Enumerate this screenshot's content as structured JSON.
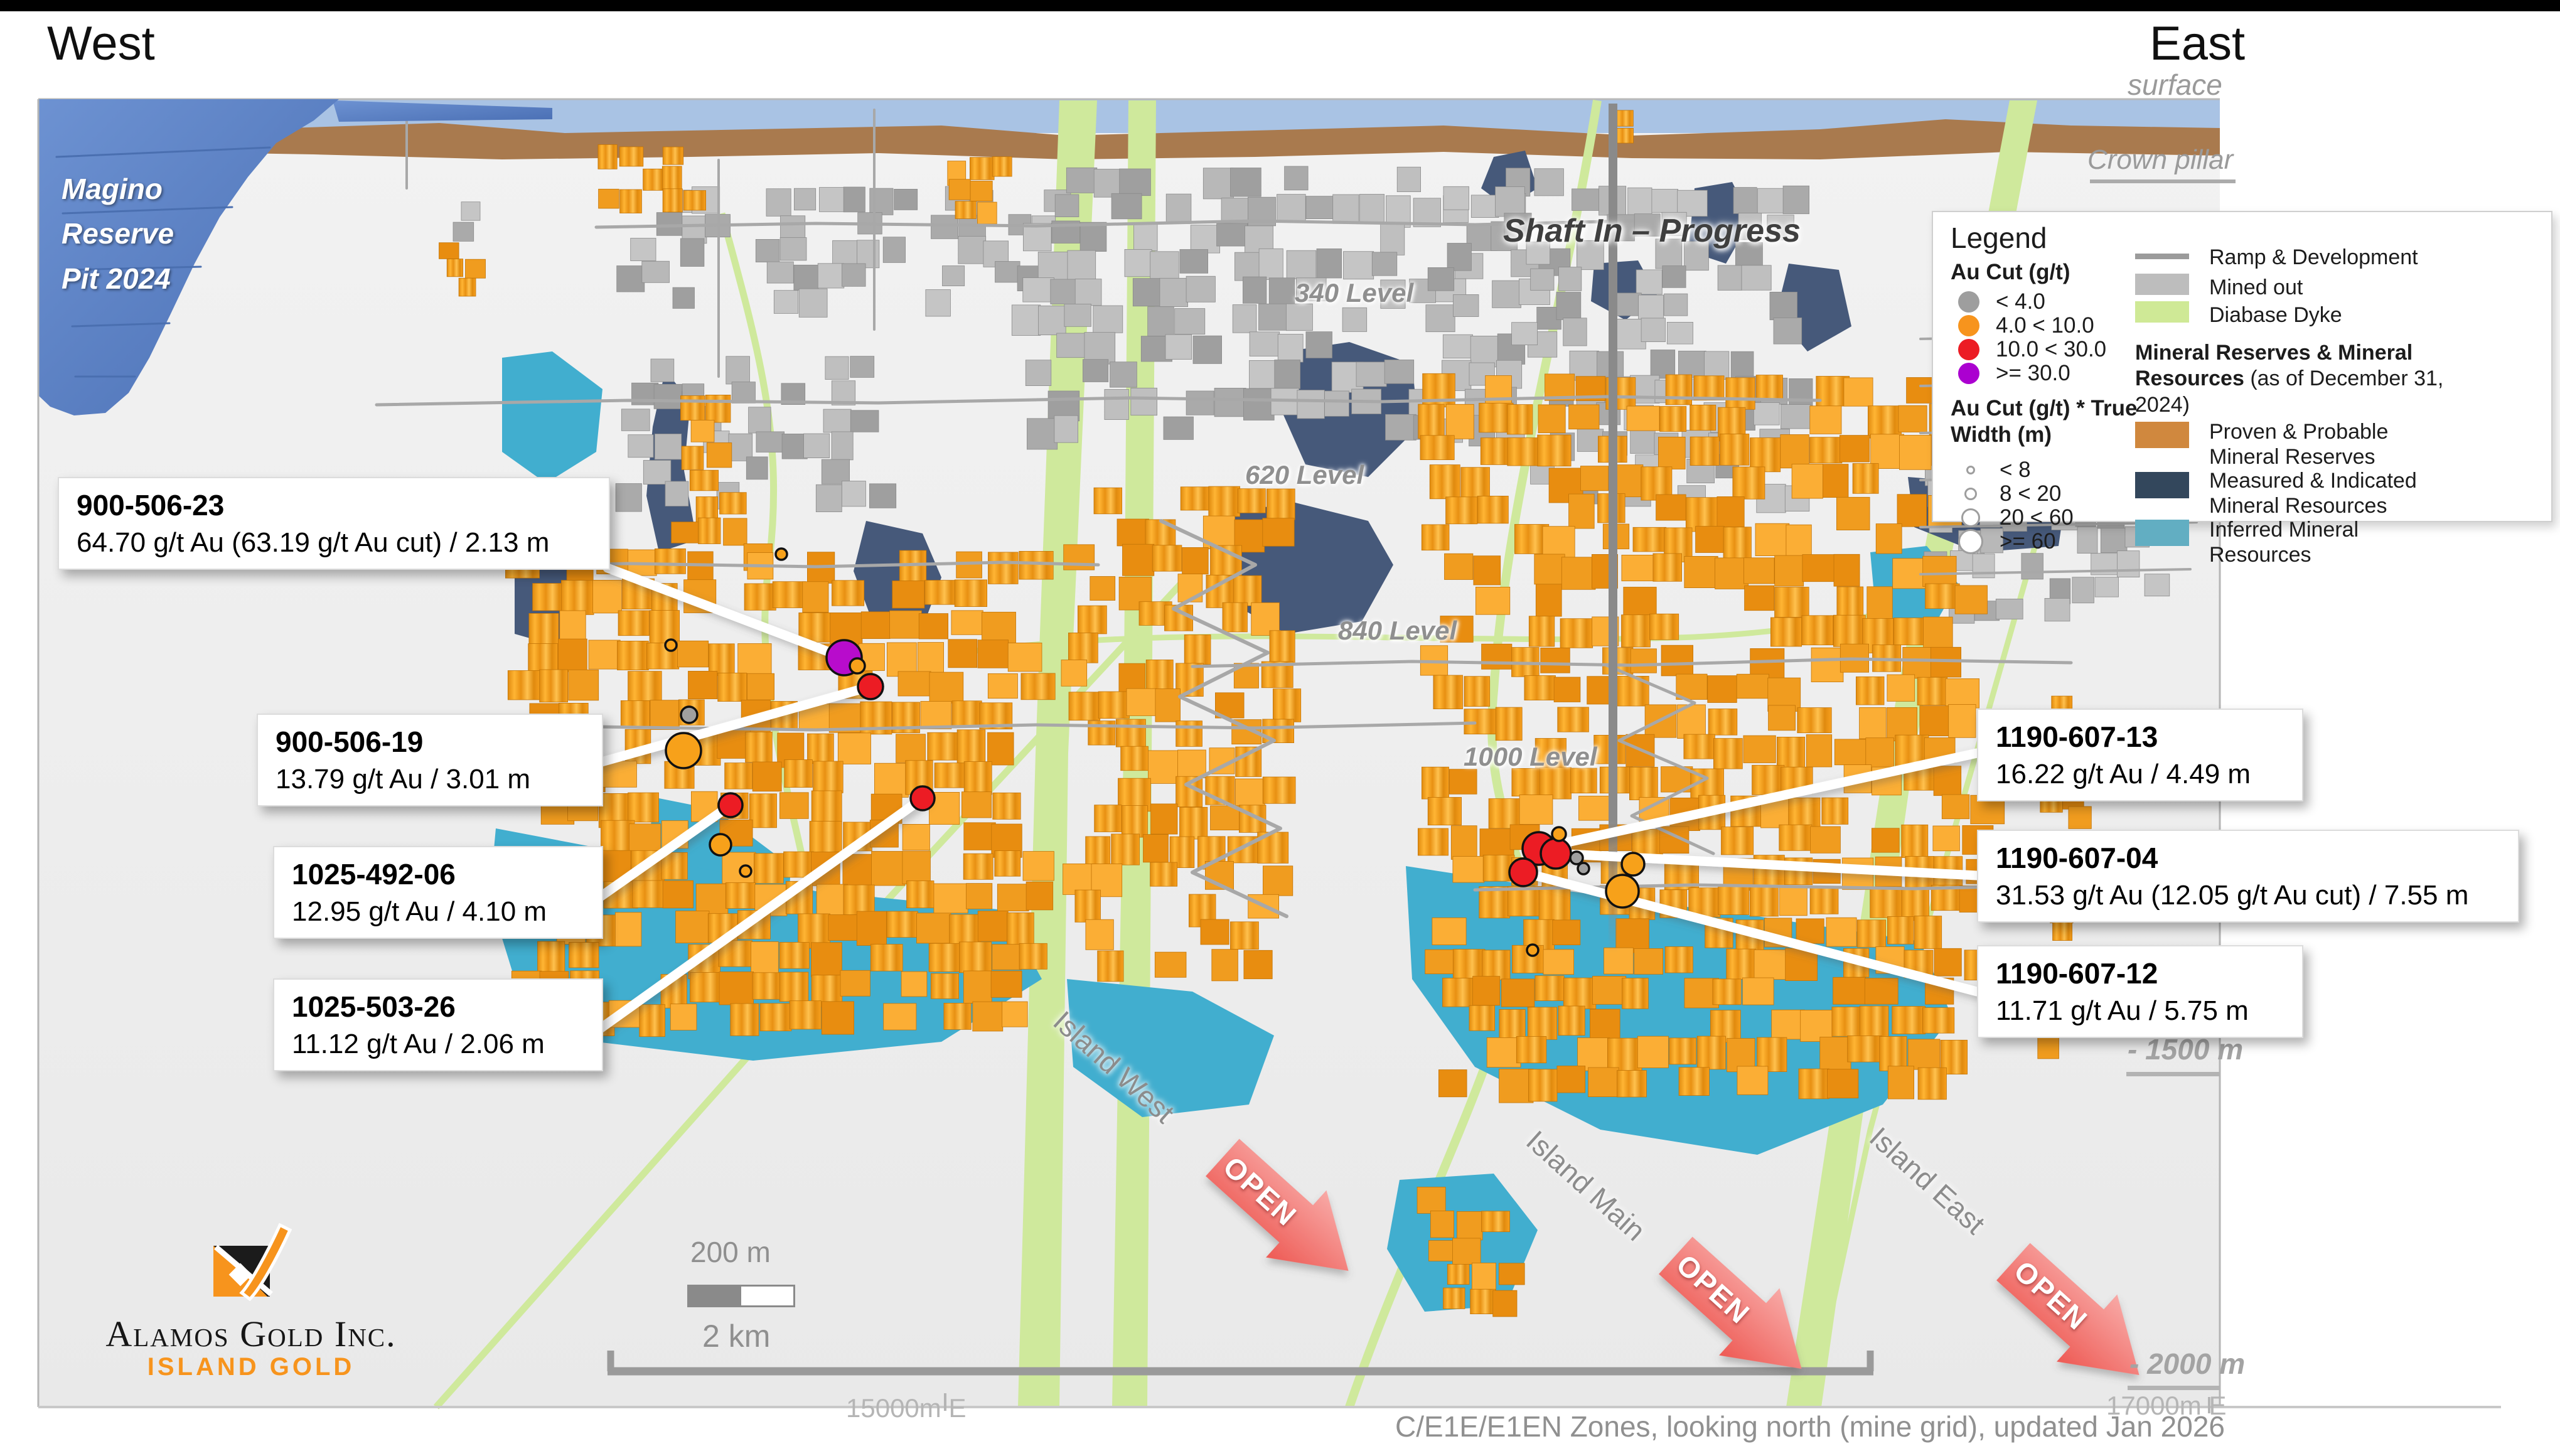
{
  "page": {
    "west": "West",
    "east": "East",
    "surface": "surface",
    "crown_pillar": "Crown pillar",
    "caption": "C/E1E/E1EN Zones, looking north (mine grid), updated Jan 2026"
  },
  "pit": {
    "line1": "Magino",
    "line2": "Reserve",
    "line3": "Pit 2024"
  },
  "shaft_label": "Shaft In – Progress",
  "levels": [
    {
      "label": "340 Level"
    },
    {
      "label": "620 Level"
    },
    {
      "label": "840 Level"
    },
    {
      "label": "1000 Level"
    }
  ],
  "callouts": [
    {
      "hole_id": "900-506-23",
      "result": "64.70 g/t Au (63.19 g/t Au cut) / 2.13 m"
    },
    {
      "hole_id": "900-506-19",
      "result": "13.79 g/t Au / 3.01 m"
    },
    {
      "hole_id": "1025-492-06",
      "result": "12.95 g/t Au / 4.10 m"
    },
    {
      "hole_id": "1025-503-26",
      "result": "11.12 g/t Au / 2.06 m"
    },
    {
      "hole_id": "1190-607-13",
      "result": "16.22 g/t Au / 4.49 m"
    },
    {
      "hole_id": "1190-607-04",
      "result": "31.53 g/t Au (12.05 g/t Au cut) / 7.55 m"
    },
    {
      "hole_id": "1190-607-12",
      "result": "11.71 g/t Au / 5.75 m"
    }
  ],
  "legend": {
    "title": "Legend",
    "au_heading": "Au Cut (g/t)",
    "au_classes": [
      {
        "label": "< 4.0",
        "color": "#9e9e9e"
      },
      {
        "label": "4.0 < 10.0",
        "color": "#f7941d"
      },
      {
        "label": "10.0 < 30.0",
        "color": "#ec1c24"
      },
      {
        "label": ">= 30.0",
        "color": "#ab00d0"
      }
    ],
    "width_heading": "Au Cut (g/t) * True Width (m)",
    "width_classes": [
      {
        "label": "< 8"
      },
      {
        "label": "8 < 20"
      },
      {
        "label": "20 < 60"
      },
      {
        "label": ">= 60"
      }
    ],
    "line_items": [
      {
        "label": "Ramp & Development",
        "color": "#9b9b9b"
      },
      {
        "label": "Mined out",
        "color": "#bdbdbd"
      },
      {
        "label": "Diabase Dyke",
        "color": "#cfe996"
      }
    ],
    "resources_heading_bold": "Mineral Reserves & Mineral Resources",
    "resources_heading_rest": " (as of December 31, 2024)",
    "resource_classes": [
      {
        "label": "Proven & Probable Mineral Reserves",
        "color": "#d0883e"
      },
      {
        "label": "Measured & Indicated Mineral Resources",
        "color": "#33475c"
      },
      {
        "label": "Inferred Mineral Resources",
        "color": "#62aec2"
      }
    ]
  },
  "zones": [
    {
      "label": "Island West"
    },
    {
      "label": "Island Main"
    },
    {
      "label": "Island East"
    }
  ],
  "open_label": "OPEN",
  "depth_markers": [
    {
      "label": "- 1500 m"
    },
    {
      "label": "- 2000 m"
    }
  ],
  "scale_bars": {
    "small": "200 m",
    "large": "2 km"
  },
  "easting_labels": [
    {
      "label": "15000m E"
    },
    {
      "label": "17000m E"
    }
  ],
  "logo": {
    "company": "Alamos Gold Inc.",
    "division": "ISLAND GOLD"
  },
  "map_colors": {
    "mined_out": "#b5b5b5",
    "stopes_proven_probable": "#f09c1f",
    "measured_indicated": "#46597a",
    "inferred": "#41aecf",
    "diabase_dyke": "#cfe99c",
    "pit": "#5b82c6",
    "overburden": "#a97a4e",
    "sky_band": "#a9c3e4",
    "open_arrow": "#ee5a54",
    "drill_dot_red": "#ec1c24",
    "drill_dot_orange": "#f7a11a",
    "drill_dot_purple": "#b80ccc",
    "drill_dot_gray": "#a0a0a0"
  }
}
